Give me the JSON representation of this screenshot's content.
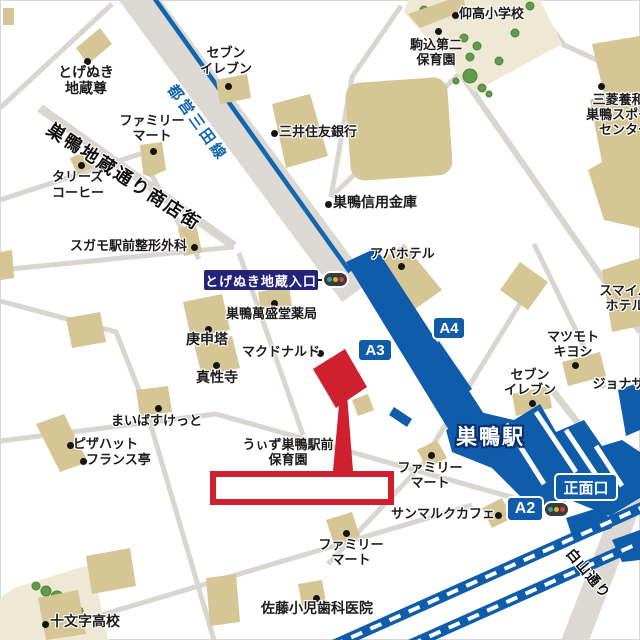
{
  "colors": {
    "station_blue": "#0f5cab",
    "mita_line_blue": "#1166ad",
    "building_beige": "#d6c695",
    "road_gray": "#d9d5d1",
    "highlight_red": "#cf2030",
    "entrance_badge_navy": "#232379",
    "tree_green": "#5f9d4a",
    "schoolground_cream": "#efe8d5",
    "signal_green": "#2ba79b",
    "signal_yellow": "#dfae2a",
    "signal_red": "#cf4633"
  },
  "labels": {
    "gyoko_elementary": "仰高小学校",
    "komagome_daini_nursery": "駒込第二\n保育園",
    "mitsubishi_sports_center": "三菱養和会\n巣鴨スポーツ\nセンター",
    "seven_eleven_north": "セブン\nイレブン",
    "mitsui_sumitomo_bank": "三井住友銀行",
    "sugamo_shinkin_bank": "巣鴨信用金庫",
    "togenuki_jizoson": "とげぬき\n地蔵尊",
    "family_mart_north": "ファミリー\nマート",
    "tullys_coffee": "タリーズ\nコーヒー",
    "sugamo_seikei_clinic": "スガモ駅前整形外科",
    "sugamo_manseido_pharmacy": "巣鴨萬盛堂薬局",
    "koshinto": "庚申塔",
    "mcdonalds": "マクドナルド",
    "shinshoji_temple": "真性寺",
    "apa_hotel": "アパホテル",
    "smile_hotel": "スマイル\nホテル",
    "matsumoto_kiyoshi": "マツモト\nキヨシ",
    "seven_eleven_east": "セブン\nイレブン",
    "jonathan": "ジョナサン",
    "san_marc_cafe": "サンマルクカフェ",
    "with_sugamo_nursery": "うぃず巣鴨駅前\n保育園",
    "family_mart_center": "ファミリー\nマート",
    "family_mart_south": "ファミリー\nマート",
    "pizza_hut": "ピザハット",
    "france_tei": "フランス亭",
    "maibasuketto": "まいばすけっと",
    "sato_pediatric_dental": "佐藤小児歯科医院",
    "jumonji_high_school": "十文字高校"
  },
  "badges": {
    "togenuki_entrance": "とげぬき地蔵入口",
    "exit_a2": "A2",
    "exit_a3": "A3",
    "exit_a4": "A4",
    "main_entrance": "正面口"
  },
  "station": {
    "name": "巣鴨駅"
  },
  "roads": {
    "shotengai": "巣鴨地蔵通り商店街",
    "toei_mita_line": "都営三田線",
    "hakusan_dori": "白山通り"
  }
}
